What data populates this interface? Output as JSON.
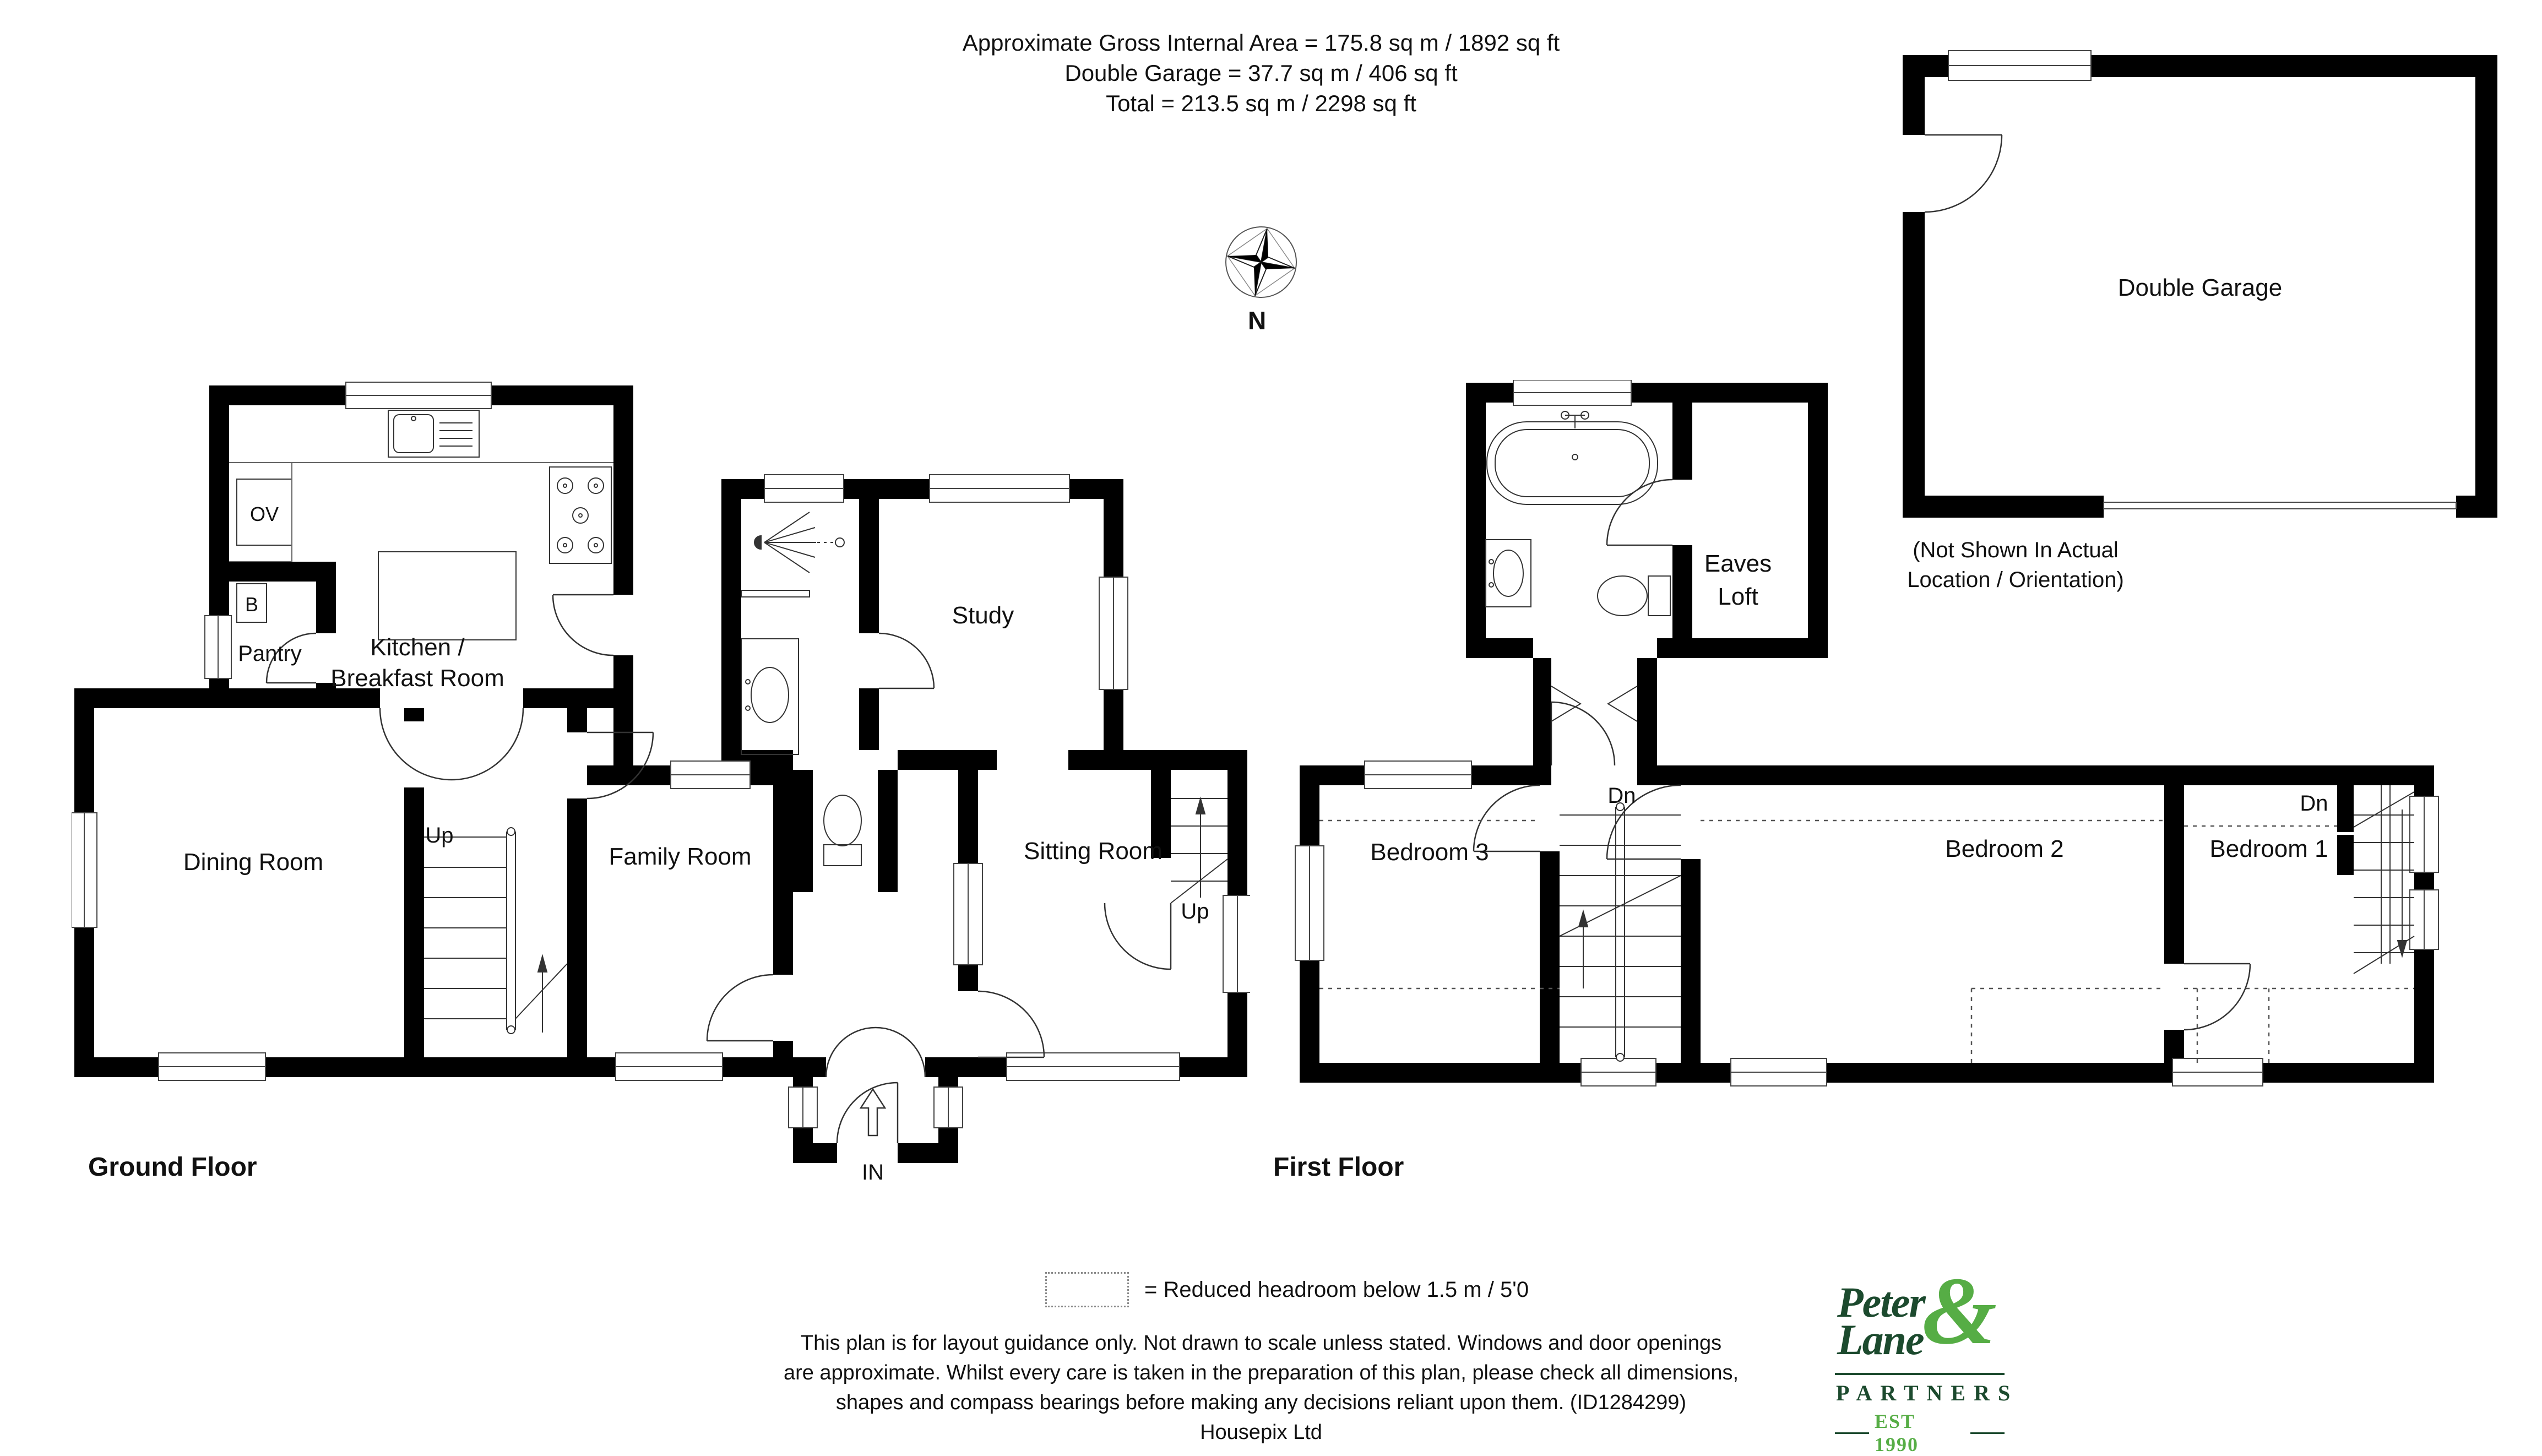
{
  "header": {
    "line1": "Approximate Gross Internal Area  = 175.8 sq m / 1892 sq ft",
    "line2": "Double Garage = 37.7 sq m / 406 sq ft",
    "line3": "Total = 213.5 sq m / 2298 sq ft"
  },
  "compass": {
    "north": "N"
  },
  "ground": {
    "title": "Ground Floor",
    "kitchen_line1": "Kitchen /",
    "kitchen_line2": "Breakfast Room",
    "pantry": "Pantry",
    "oven": "OV",
    "boiler": "B",
    "dining": "Dining Room",
    "family": "Family Room",
    "study": "Study",
    "sitting": "Sitting Room",
    "up": "Up",
    "entrance": "IN"
  },
  "first": {
    "title": "First Floor",
    "bed1": "Bedroom 1",
    "bed2": "Bedroom 2",
    "bed3": "Bedroom 3",
    "eaves_line1": "Eaves",
    "eaves_line2": "Loft",
    "down": "Dn"
  },
  "garage": {
    "label": "Double Garage",
    "note_line1": "(Not Shown In Actual",
    "note_line2": "Location / Orientation)"
  },
  "legend": {
    "text": "=  Reduced headroom below 1.5 m / 5'0"
  },
  "disclaimer": {
    "line1": "This plan is for layout guidance only. Not drawn to scale unless stated. Windows and door openings",
    "line2": "are approximate. Whilst every care is taken in the preparation of this plan, please check all dimensions,",
    "line3": "shapes and compass bearings before making any decisions reliant upon them. (ID1284299)",
    "company": "Housepix Ltd"
  },
  "logo": {
    "word1": "Peter",
    "amp": "&",
    "word2": "Lane",
    "partners": "PARTNERS",
    "est": "EST 1990"
  },
  "colors": {
    "wall": "#000000",
    "logo_dark": "#1c4a2e",
    "logo_light": "#56ad45"
  }
}
